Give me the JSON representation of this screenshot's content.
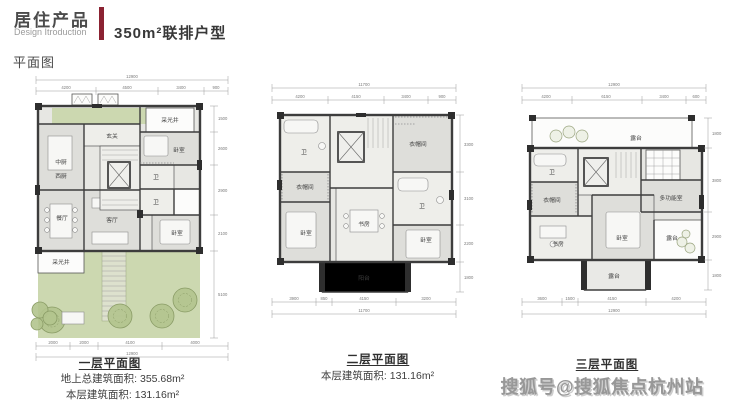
{
  "header": {
    "title_cn": "居住产品",
    "title_en": "Design Itroduction",
    "subtitle": "350m²联排户型",
    "accent_color": "#8b2232"
  },
  "section_label": "平面图",
  "watermark": "搜狐号@搜狐焦点杭州站",
  "plans": [
    {
      "caption": "一层平面图",
      "area_lines": [
        "地上总建筑面积: 355.68m²",
        "本层建筑面积: 131.16m²"
      ],
      "dims_total_top": "12900",
      "dims_top": [
        "4200",
        "4500",
        "3400",
        "900"
      ],
      "dims_bottom": [
        "2000",
        "2000",
        "4100",
        "4000"
      ],
      "dims_total_bottom": "12900",
      "dims_right": [
        "1500",
        "2600",
        "2900",
        "2100",
        "5100"
      ],
      "rooms": {
        "kitchen1": "中厨",
        "kitchen2": "西厨",
        "foyer": "玄关",
        "lightwell": "采光井",
        "bedroom1": "卧室",
        "bath1": "卫",
        "bath2": "卫",
        "dining": "餐厅",
        "living": "客厅",
        "bedroom2": "卧室",
        "lightwell2": "采光井"
      }
    },
    {
      "caption": "二层平面图",
      "area_lines": [
        "本层建筑面积: 131.16m²"
      ],
      "dims_total_top": "11700",
      "dims_top": [
        "4200",
        "4150",
        "3400",
        "900"
      ],
      "dims_bottom": [
        "3900",
        "850",
        "4150",
        "3200"
      ],
      "dims_total_bottom": "11700",
      "dims_right": [
        "3300",
        "3100",
        "2200",
        "1800"
      ],
      "rooms": {
        "bath1": "卫",
        "cloak1": "衣帽间",
        "bedroom1": "卧室",
        "study": "书房",
        "balcony": "阳台",
        "cloak2": "衣帽间",
        "bath2": "卫",
        "bedroom2": "卧室"
      }
    },
    {
      "caption": "三层平面图",
      "area_lines": [],
      "dims_total_top": "12900",
      "dims_top": [
        "4200",
        "6150",
        "3400",
        "600"
      ],
      "dims_bottom": [
        "3600",
        "1500",
        "4150",
        "4200"
      ],
      "dims_total_bottom": "12900",
      "dims_right": [
        "1800",
        "3800",
        "2900",
        "1800"
      ],
      "rooms": {
        "terrace_top": "露台",
        "bath": "卫",
        "cloak": "衣帽间",
        "multi": "多功能室",
        "study": "书房",
        "bedroom": "卧室",
        "terrace_right": "露台",
        "terrace_bottom": "露台"
      }
    }
  ]
}
